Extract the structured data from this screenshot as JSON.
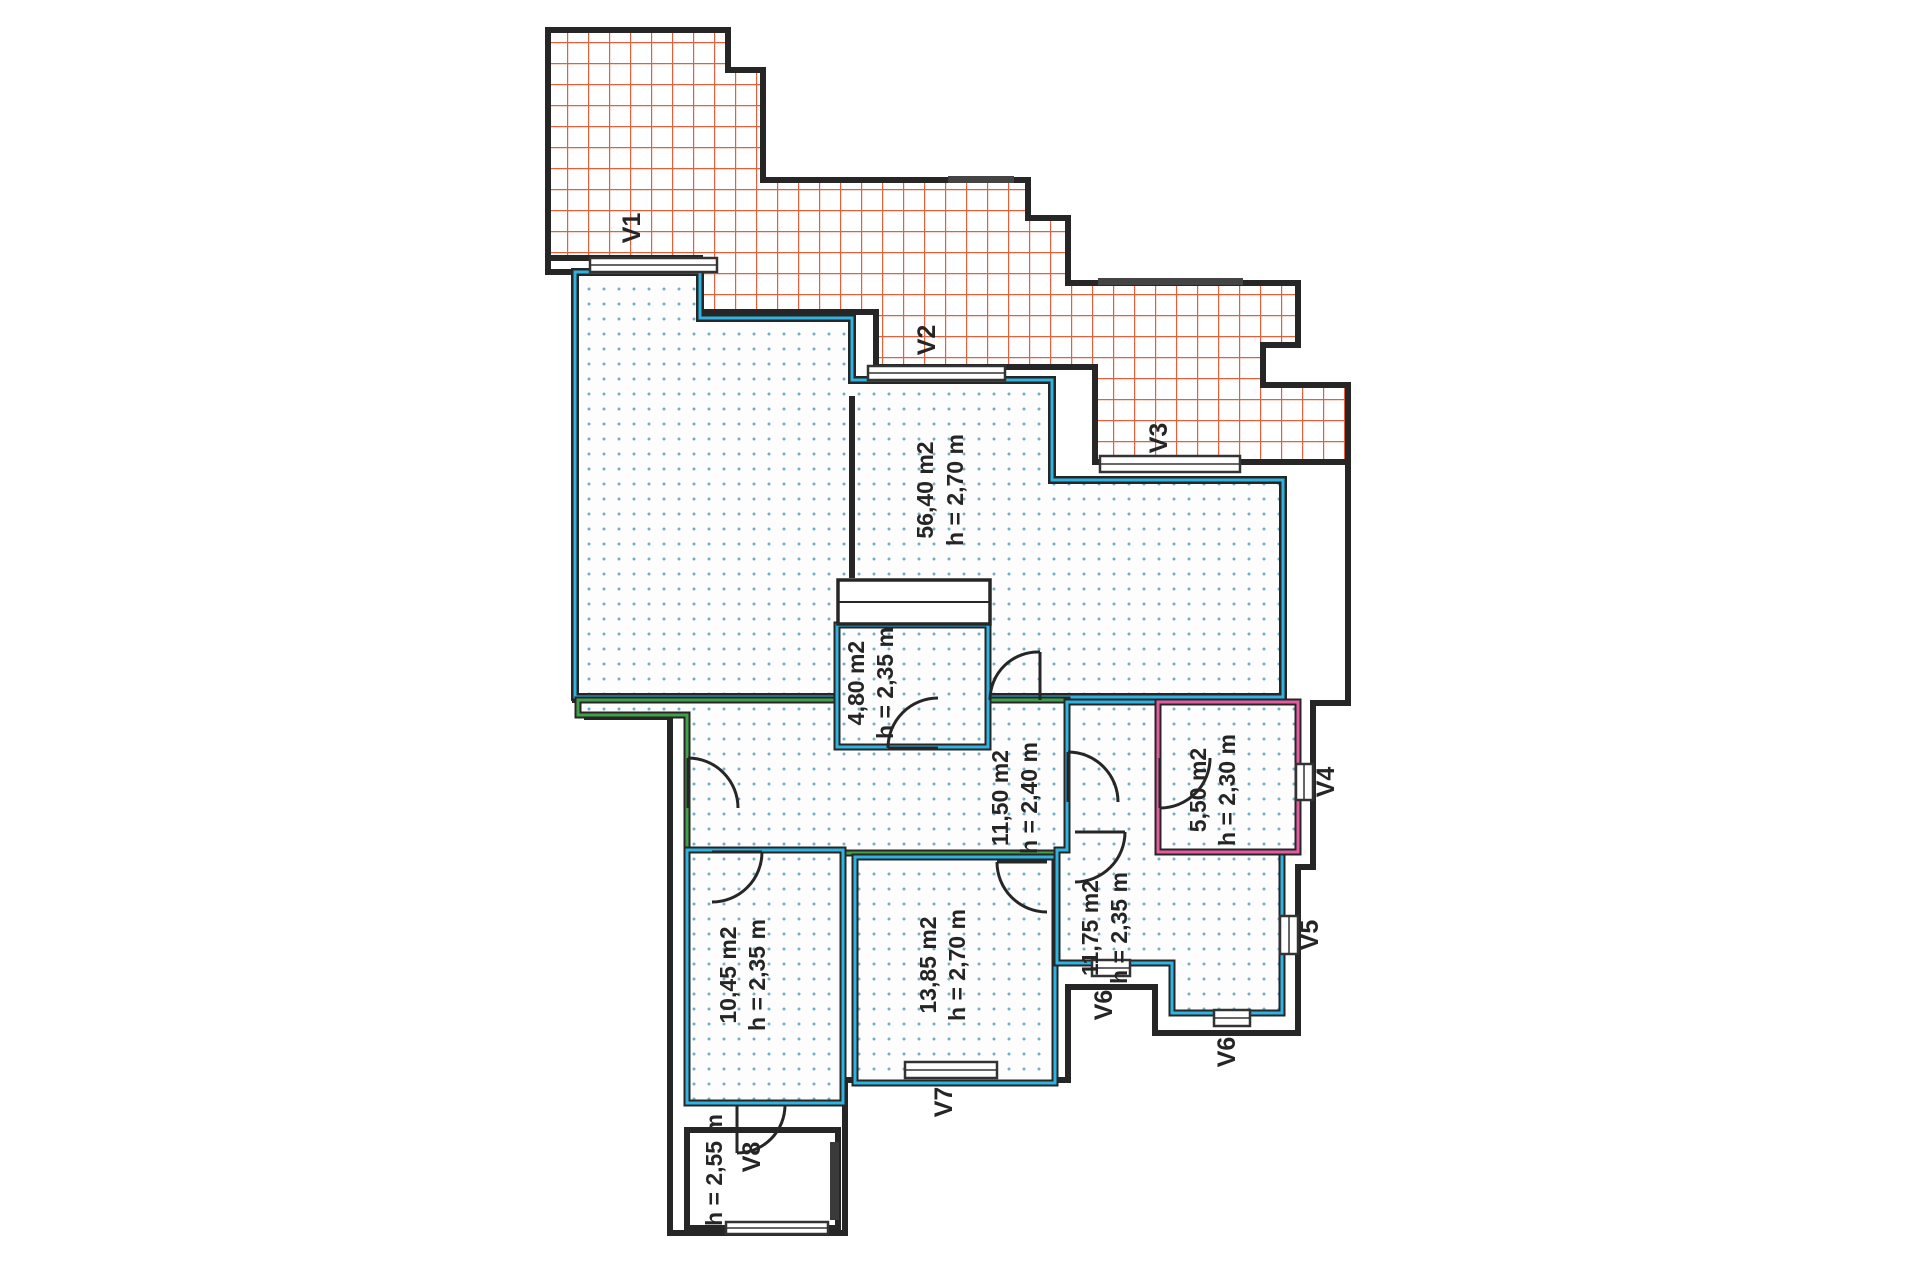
{
  "plan": {
    "type": "apartment-floor-plan",
    "rooms": [
      {
        "id": "room-56-40",
        "area": "56,40 m2",
        "ceiling": "h = 2,70 m"
      },
      {
        "id": "room-4-80",
        "area": "4,80 m2",
        "ceiling": "h = 2,35 m"
      },
      {
        "id": "room-11-50",
        "area": "11,50 m2",
        "ceiling": "h = 2,40 m"
      },
      {
        "id": "room-5-50",
        "area": "5,50 m2",
        "ceiling": "h = 2,30 m"
      },
      {
        "id": "room-11-75",
        "area": "11,75 m2",
        "ceiling": "h = 2,35 m"
      },
      {
        "id": "room-13-85",
        "area": "13,85 m2",
        "ceiling": "h = 2,70 m"
      },
      {
        "id": "room-10-45",
        "area": "10,45 m2",
        "ceiling": "h = 2,35 m"
      },
      {
        "id": "room-bottom",
        "ceiling": "h = 2,55 m"
      }
    ],
    "windows": [
      {
        "label": "V1"
      },
      {
        "label": "V2"
      },
      {
        "label": "V3"
      },
      {
        "label": "V4"
      },
      {
        "label": "V5"
      },
      {
        "label": "V6"
      },
      {
        "label": "V6"
      },
      {
        "label": "V7"
      },
      {
        "label": "V8"
      }
    ],
    "colors": {
      "wall": "#262626",
      "terrace_hatch": "#e2603c",
      "room_dots": "#74aec5",
      "room_outline_cyan": "#2fb3e0",
      "hall_outline_green": "#43a04a",
      "room_outline_pink": "#e45ba2"
    }
  }
}
